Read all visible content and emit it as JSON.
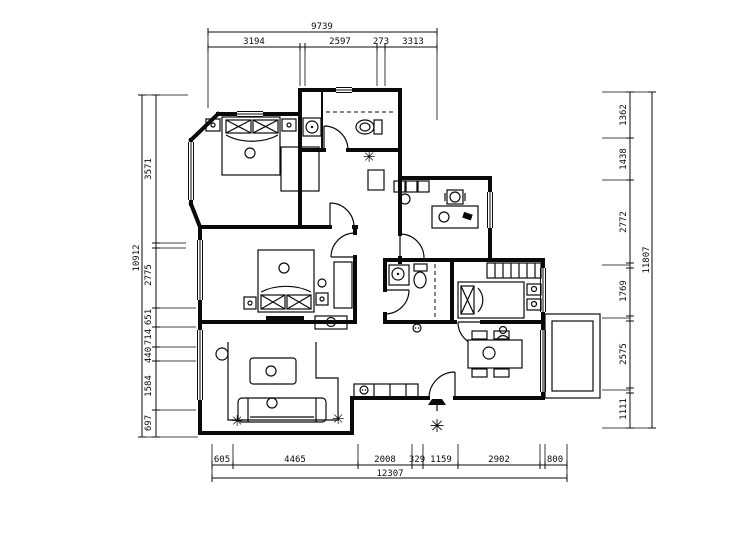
{
  "drawing": {
    "type": "apartment floor plan",
    "colors": {
      "ink": "#0a0a0a",
      "paper": "#ffffff"
    },
    "glyphs": {
      "plant": "✳"
    },
    "dims": {
      "top": {
        "total": "9739",
        "segments": [
          "3194",
          "2597",
          "273",
          "3313"
        ]
      },
      "bottom": {
        "total": "12307",
        "segments": [
          "605",
          "4465",
          "2008",
          "329",
          "1159",
          "2902",
          "800"
        ]
      },
      "left": {
        "total": "10912",
        "segments": [
          "3571",
          "2775",
          "651",
          "714",
          "440",
          "1584",
          "697"
        ]
      },
      "right": {
        "total": "11807",
        "segments": [
          "1362",
          "1438",
          "2772",
          "1769",
          "2575",
          "1111"
        ]
      }
    }
  }
}
